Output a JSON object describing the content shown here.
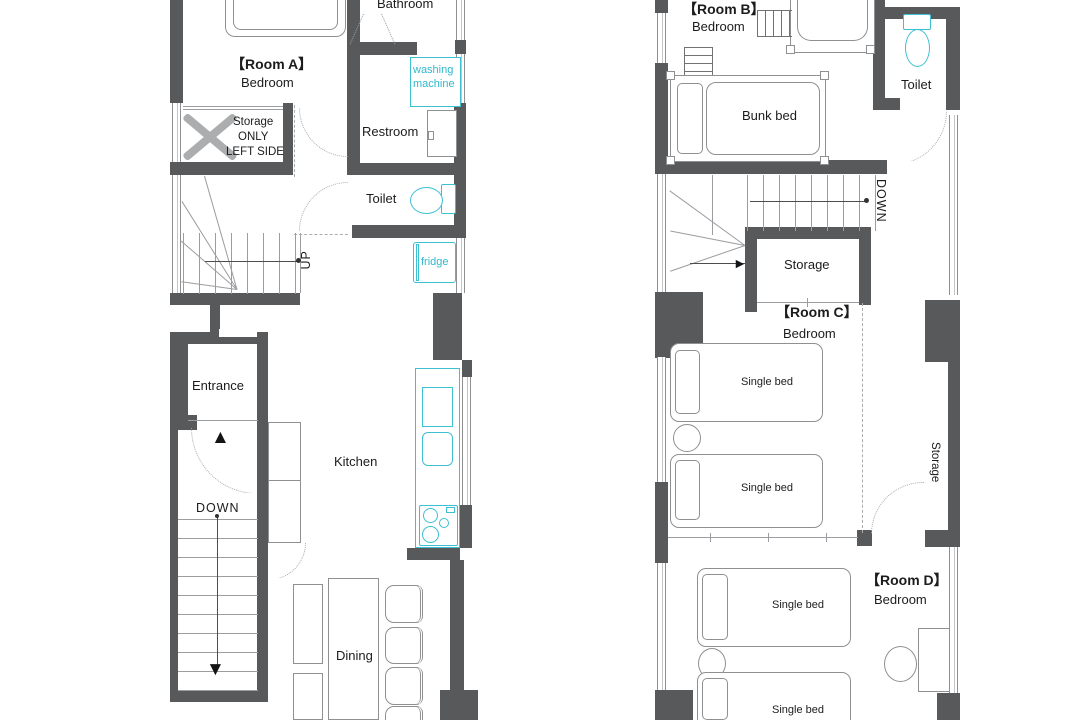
{
  "floor1": {
    "room_a": {
      "title": "【Room A】",
      "type": "Bedroom"
    },
    "bathroom": "Bathroom",
    "washing_machine": {
      "line1": "washing",
      "line2": "machine"
    },
    "restroom": "Restroom",
    "toilet": "Toilet",
    "storage_closet": {
      "line1": "Storage",
      "line2": "ONLY",
      "line3": "LEFT SIDE"
    },
    "stairs_up": "UP",
    "fridge": "fridge",
    "entrance": "Entrance",
    "stairs_down": "DOWN",
    "kitchen": "Kitchen",
    "dining": "Dining"
  },
  "floor2": {
    "room_b": {
      "title": "【Room B】",
      "type": "Bedroom",
      "bunk_bed": "Bunk bed"
    },
    "toilet": "Toilet",
    "stairs_down": "DOWN",
    "storage_hall": "Storage",
    "room_c": {
      "title": "【Room C】",
      "type": "Bedroom",
      "bed1": "Single bed",
      "bed2": "Single bed"
    },
    "storage_wall": "Storage",
    "room_d": {
      "title": "【Room D】",
      "type": "Bedroom",
      "bed1": "Single bed",
      "bed2": "Single bed"
    }
  },
  "icons": {
    "entrance_arrow": "▲",
    "down_arrow": "▼",
    "turn_arrow_left": "►",
    "turn_arrow_right": "►"
  },
  "colors": {
    "wall": "#58595b",
    "fixture": "#3ec0d3",
    "fixture_text": "#2fb9cc",
    "furniture_line": "#8e9092"
  }
}
